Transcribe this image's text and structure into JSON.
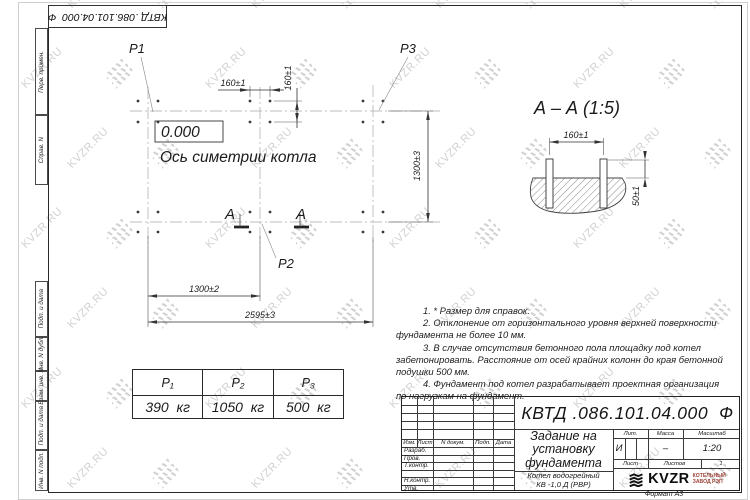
{
  "designation": "КВТД .086.101.04.000  Ф",
  "margin": {
    "labels": [
      "Перв. примен.",
      "Справ. N",
      "Подп. и дата",
      "Инв. N дубл.",
      "Взам. инв. N",
      "Подп. и дата",
      "Инв. N подл."
    ]
  },
  "plan": {
    "p1": "P1",
    "p2": "P2",
    "p3": "P3",
    "elevation": "0.000",
    "axis_label": "Ось симетрии котла",
    "section_letter": "А",
    "dim_bolt_h": "160±1",
    "dim_bolt_v": "160±1",
    "dim_width": "1300±3",
    "dim_half": "1300±2",
    "dim_total": "2595±3"
  },
  "section": {
    "title": "А – А (1:5)",
    "dim_bolts": "160±1",
    "dim_protrusion": "50±1"
  },
  "notes": [
    [
      "1. * Размер для справок."
    ],
    [
      "2. Отклонение от горизонтального уровня верхней поверхности",
      "фундамента не более 10 мм."
    ],
    [
      "3. В случае отсутствия бетонного пола площадку под котел",
      "забетонировать. Расстояние от осей крайних колонн до края бетонной",
      "подушки 500 мм."
    ],
    [
      "4. Фундамент под котел разрабатывает проектная организация",
      "по нагрузкам на фундамент."
    ]
  ],
  "load_table": {
    "headers": [
      "P₁",
      "P₂",
      "P₃"
    ],
    "values": [
      "390  кг",
      "1050  кг",
      "500  кг"
    ]
  },
  "title_block": {
    "rev_cols": [
      "Изм.",
      "Лист",
      "N докум.",
      "Подп.",
      "Дата"
    ],
    "roles": [
      "Разраб.",
      "Пров.",
      "Т.контр.",
      "Н.контр.",
      "Утв."
    ],
    "doc_title": [
      "Задание на",
      "установку",
      "фундамента"
    ],
    "product": [
      "Котел водогрейный",
      "КВ -1,0 Д (РВР)"
    ],
    "lit_header": "Лит.",
    "mass_header": "Масса",
    "scale_header": "Масштаб",
    "lit": "И",
    "mass": "–",
    "scale": "1:20",
    "sheet_label": "Лист",
    "sheets_label": "Листов",
    "sheets_value": "1",
    "logo": "KVZR",
    "company_line1": "КОТЕЛЬНЫЙ",
    "company_line2": "ЗАВОД РЭП",
    "format": "Формат А3"
  },
  "watermark": {
    "text": "KVZR.RU"
  }
}
